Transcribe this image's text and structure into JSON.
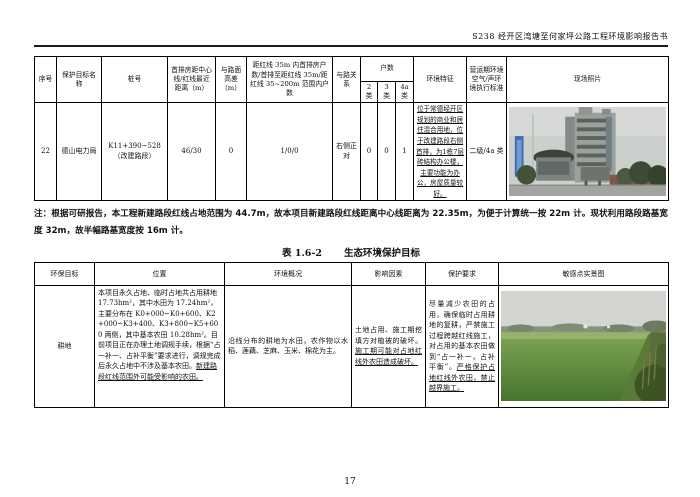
{
  "header": {
    "title": "S238 经开区湾塘至何家坪公路工程环境影响报告书"
  },
  "noise_table": {
    "headers": {
      "no": "序号",
      "name": "保护目标名称",
      "stake": "桩号",
      "dist": "首排房距中心线/红线最近距离（m）",
      "height_diff": "与路面高差（m）",
      "households_range": "距红线 35m 内首排房户数/首排至距红线 35m/距红线 35~200m 范围内户数",
      "relation": "与路关系",
      "households_group": "户数",
      "class2": "2 类",
      "class3": "3 类",
      "class4a": "4a 类",
      "env_feature": "环境特征",
      "standard": "营运期环境空气/声环境执行标准",
      "photo": "现场照片"
    },
    "row": {
      "no": "22",
      "name": "德山电力局",
      "stake": "K11+390~528（改建路段）",
      "dist": "46/30",
      "height_diff": "0",
      "households": "1/0/0",
      "relation": "右侧正对",
      "class2": "0",
      "class3": "0",
      "class4a": "1",
      "env_feature": "位于常德经开区规划的商业和居住混合用地，位于改建路段右侧首排，为1栋7层砖结构办公楼，主要功能为办公，房屋质量较好。",
      "standard": "二级/4a 类",
      "photo_desc": "office-building-site-photo"
    }
  },
  "note": "注：根据可研报告，本工程新建路段红线占地范围为 44.7m，故本项目新建路段红线距离中心线距离为 22.35m，为便于计算统一按 22m 计。现状利用路段路基宽度 32m，故半幅路基宽度按 16m 计。",
  "eco_table": {
    "caption_label": "表 1.6-2",
    "caption_text": "生态环境保护目标",
    "headers": {
      "target": "环保目标",
      "location": "位置",
      "overview": "环境概况",
      "impact": "影响因素",
      "protection": "保护要求",
      "photo": "敏感点实景图"
    },
    "row": {
      "target": "耕地",
      "location_main": "本项目永久占地、临时占地共占用耕地 17.73hm²，其中水田为 17.24hm²，主要分布在 K0+000~K0+600、K2+000~K3+400、K3+800~K5+600 两侧，其中基本农田 10.28hm²。目前项目正在办理土地调规手续，根据“占一补一、占补平衡”要求进行，调规完成后永久占地中不涉及基本农田。",
      "location_underlined": "新建路段红线范围外可能受影响的农田。",
      "overview": "沿线分布的耕地为水田，农作物以水稻、莲藕、芝麻、玉米、棉花为主。",
      "impact_main": "土地占用、施工期挖填方对植被的破坏。",
      "impact_underlined": "施工期可能对占地红线外农田造成破坏。",
      "protection_main": "尽量减少农田的占用，确保临时占用耕地的复耕，严禁施工过程跨越红线施工，对占用的基本农田做到“占一补一，占补平衡”。",
      "protection_underlined": "严格保护占地红线外农田，禁止越界施工。",
      "photo_desc": "rice-paddy-field-photo"
    }
  },
  "footer": {
    "page_number": "17"
  },
  "colors": {
    "border": "#000000",
    "field_green": "#5d8c3a",
    "sky_gray": "#d0d4cf",
    "sign_blue": "#3f6db0"
  }
}
